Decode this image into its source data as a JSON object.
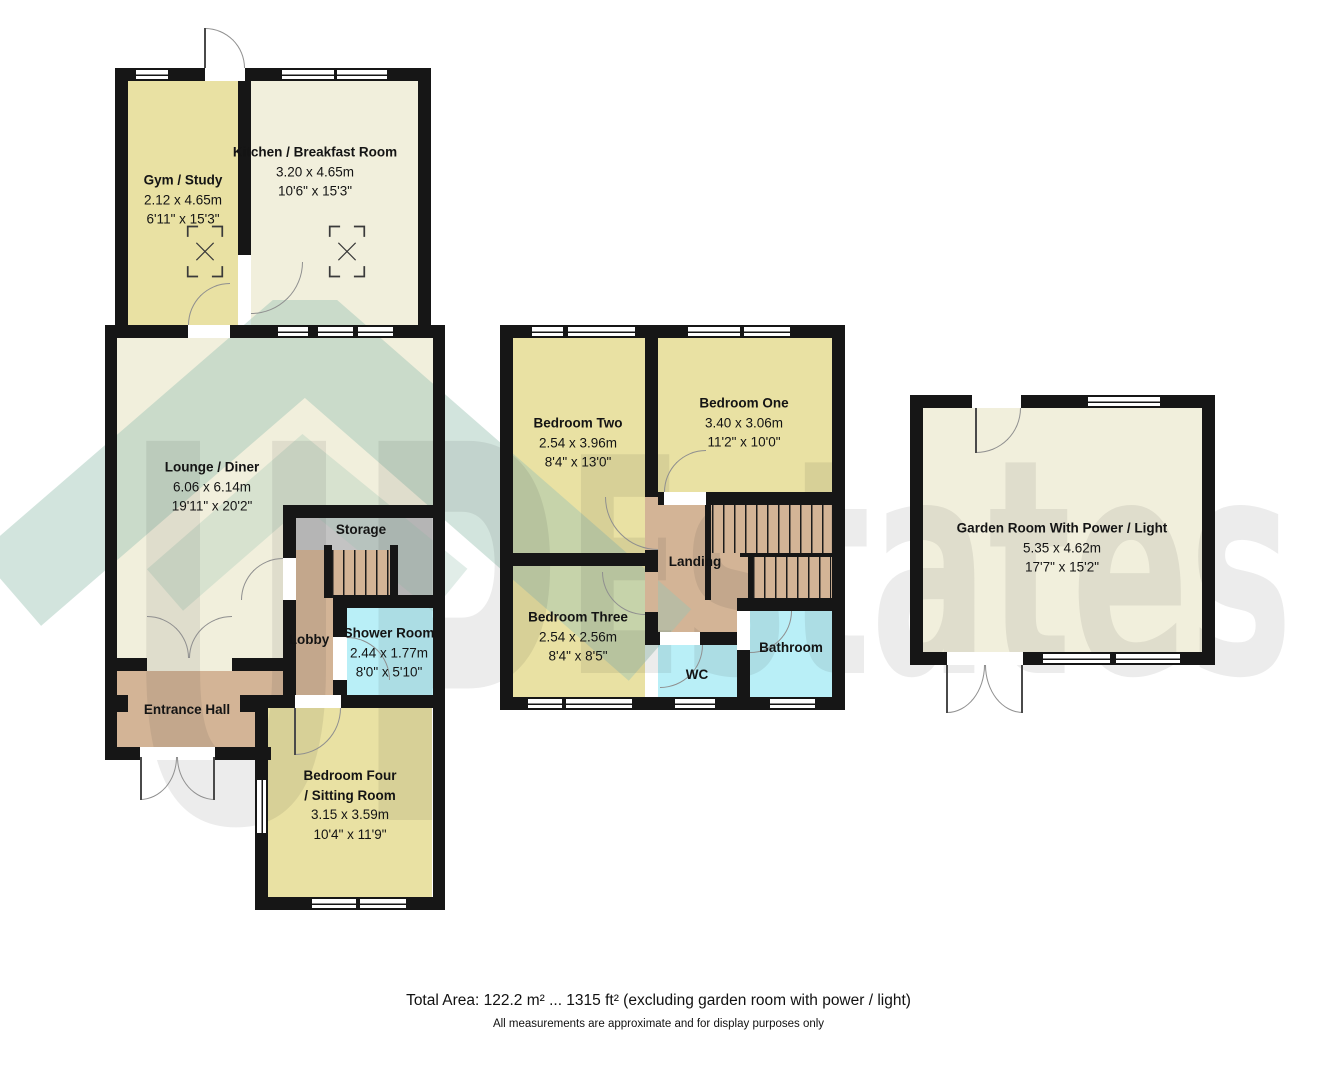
{
  "watermark": {
    "text": "UP Estates",
    "up": "UP",
    "estates": "Estates"
  },
  "rooms": {
    "gym": {
      "name": "Gym / Study",
      "metric": "2.12 x 4.65m",
      "imperial": "6'11\" x 15'3\""
    },
    "kitchen": {
      "name": "Kitchen / Breakfast Room",
      "metric": "3.20 x 4.65m",
      "imperial": "10'6\" x 15'3\""
    },
    "lounge": {
      "name": "Lounge / Diner",
      "metric": "6.06 x 6.14m",
      "imperial": "19'11\" x 20'2\""
    },
    "storage": {
      "name": "Storage"
    },
    "lobby": {
      "name": "Lobby"
    },
    "shower": {
      "name": "Shower Room",
      "metric": "2.44 x 1.77m",
      "imperial": "8'0\" x 5'10\""
    },
    "entrance": {
      "name": "Entrance Hall"
    },
    "bedroom4": {
      "name_line1": "Bedroom Four",
      "name_line2": "/ Sitting Room",
      "metric": "3.15 x 3.59m",
      "imperial": "10'4\" x 11'9\""
    },
    "bedroom2": {
      "name": "Bedroom Two",
      "metric": "2.54 x 3.96m",
      "imperial": "8'4\" x 13'0\""
    },
    "bedroom1": {
      "name": "Bedroom One",
      "metric": "3.40 x 3.06m",
      "imperial": "11'2\" x 10'0\""
    },
    "landing": {
      "name": "Landing"
    },
    "bedroom3": {
      "name": "Bedroom Three",
      "metric": "2.54 x 2.56m",
      "imperial": "8'4\" x 8'5\""
    },
    "wc": {
      "name": "WC"
    },
    "bathroom": {
      "name": "Bathroom"
    },
    "garden": {
      "name": "Garden Room With Power / Light",
      "metric": "5.35 x 4.62m",
      "imperial": "17'7\" x 15'2\""
    }
  },
  "footer": {
    "total_area": "Total Area: 122.2 m² ... 1315 ft² (excluding garden room with power / light)",
    "disclaimer": "All measurements are approximate and for display purposes only"
  },
  "colors": {
    "wall": "#161616",
    "room_yellow": "#e9e1a3",
    "room_cream": "#f1efdc",
    "room_brown": "#d3b496",
    "room_gray": "#c3c3c3",
    "room_cyan": "#b9eff7",
    "watermark_teal": "#9cc3b4",
    "watermark_gray": "rgba(30,30,30,0.085)"
  }
}
